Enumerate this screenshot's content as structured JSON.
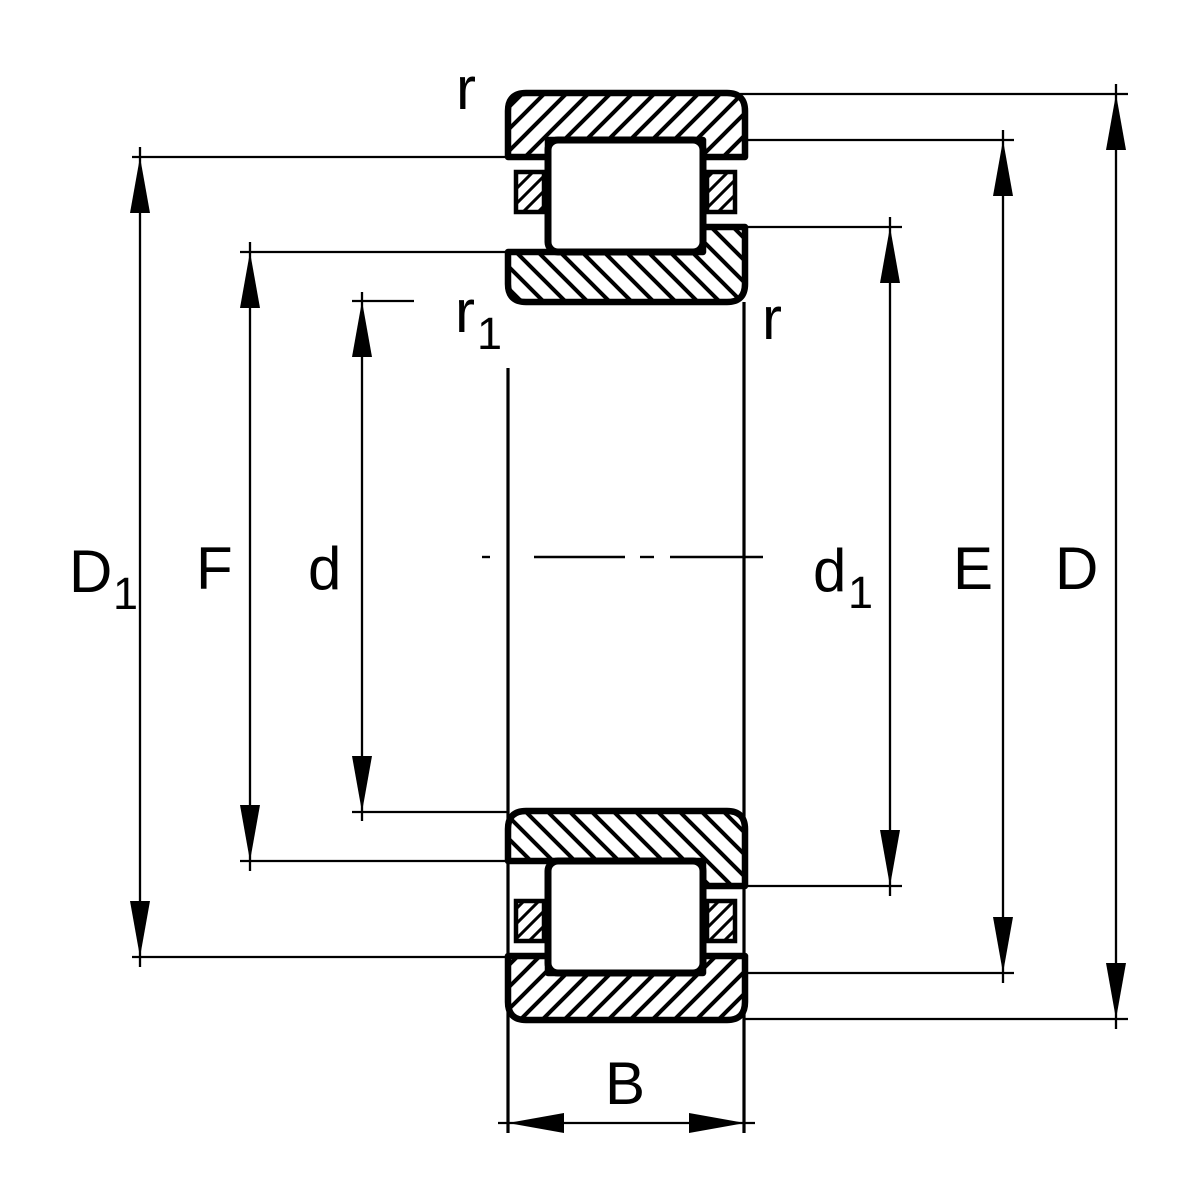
{
  "figure": {
    "kind": "technical-drawing",
    "subject": "cylindrical-roller-bearing-cross-section",
    "background_color": "#ffffff",
    "line_color": "#000000"
  },
  "labels": {
    "r_top": {
      "main": "r",
      "sub": ""
    },
    "r1_left": {
      "main": "r",
      "sub": "1"
    },
    "r_right": {
      "main": "r",
      "sub": ""
    },
    "D1": {
      "main": "D",
      "sub": "1"
    },
    "F": {
      "main": "F",
      "sub": ""
    },
    "d": {
      "main": "d",
      "sub": ""
    },
    "d1": {
      "main": "d",
      "sub": "1"
    },
    "E": {
      "main": "E",
      "sub": ""
    },
    "D": {
      "main": "D",
      "sub": ""
    },
    "B": {
      "main": "B",
      "sub": ""
    }
  }
}
